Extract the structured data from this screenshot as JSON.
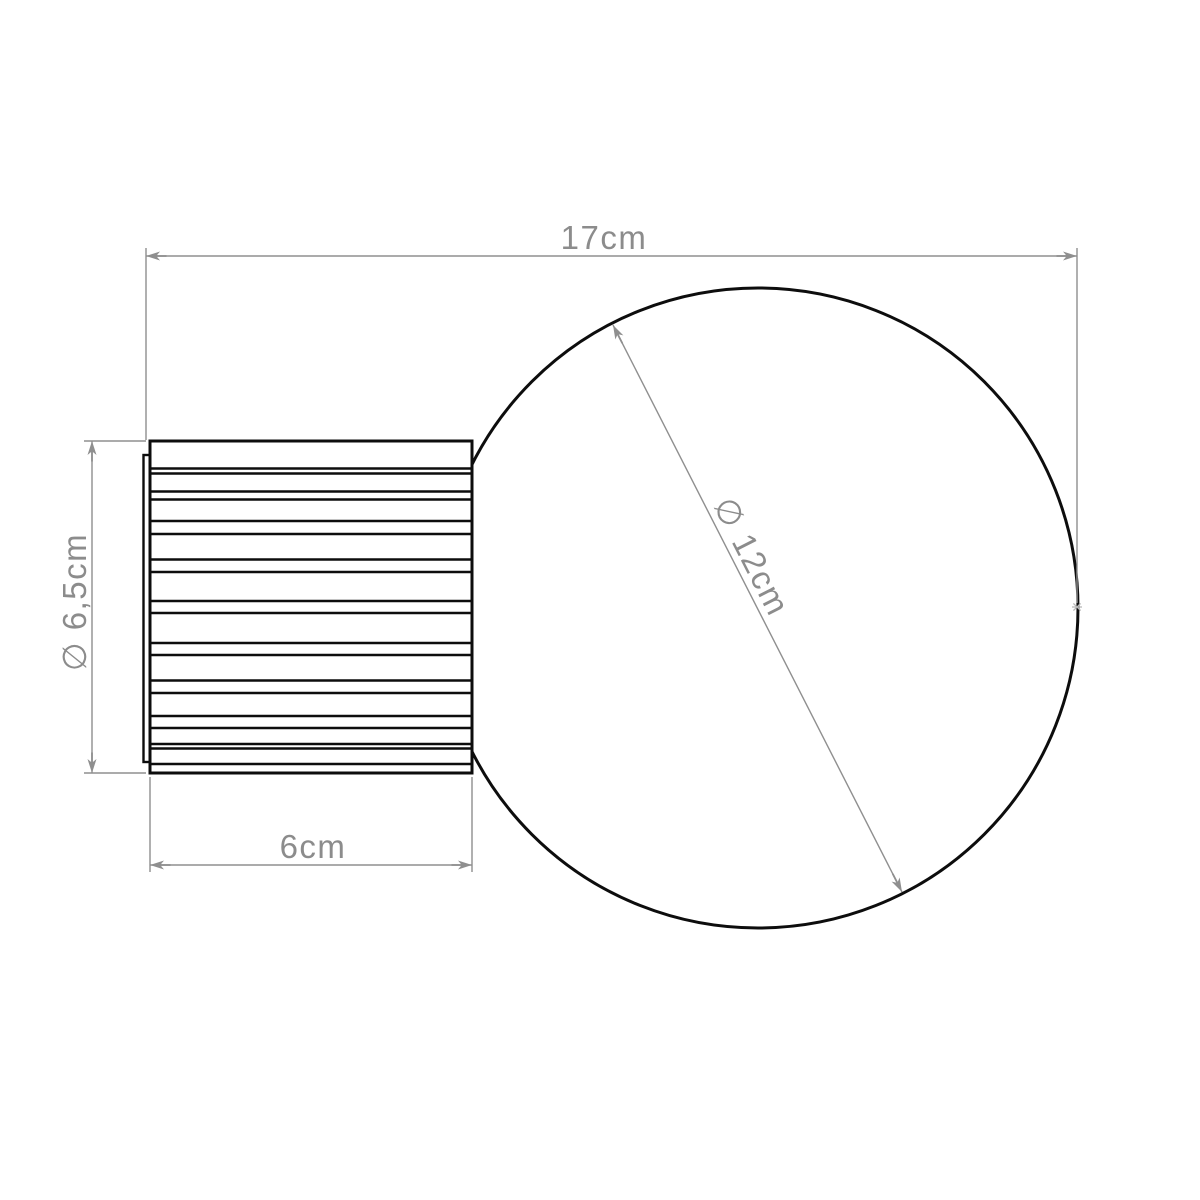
{
  "dimensions": {
    "overall_width": "17cm",
    "base_diameter": "∅ 6,5cm",
    "base_width": "6cm",
    "globe_diameter": "∅ 12cm"
  },
  "colors": {
    "outline": "#0d0d0d",
    "dimension_gray": "#8f8f8f",
    "label_gray": "#8c8c8c",
    "tangent_marker_gray": "#b8b8b8",
    "background": "#ffffff"
  }
}
